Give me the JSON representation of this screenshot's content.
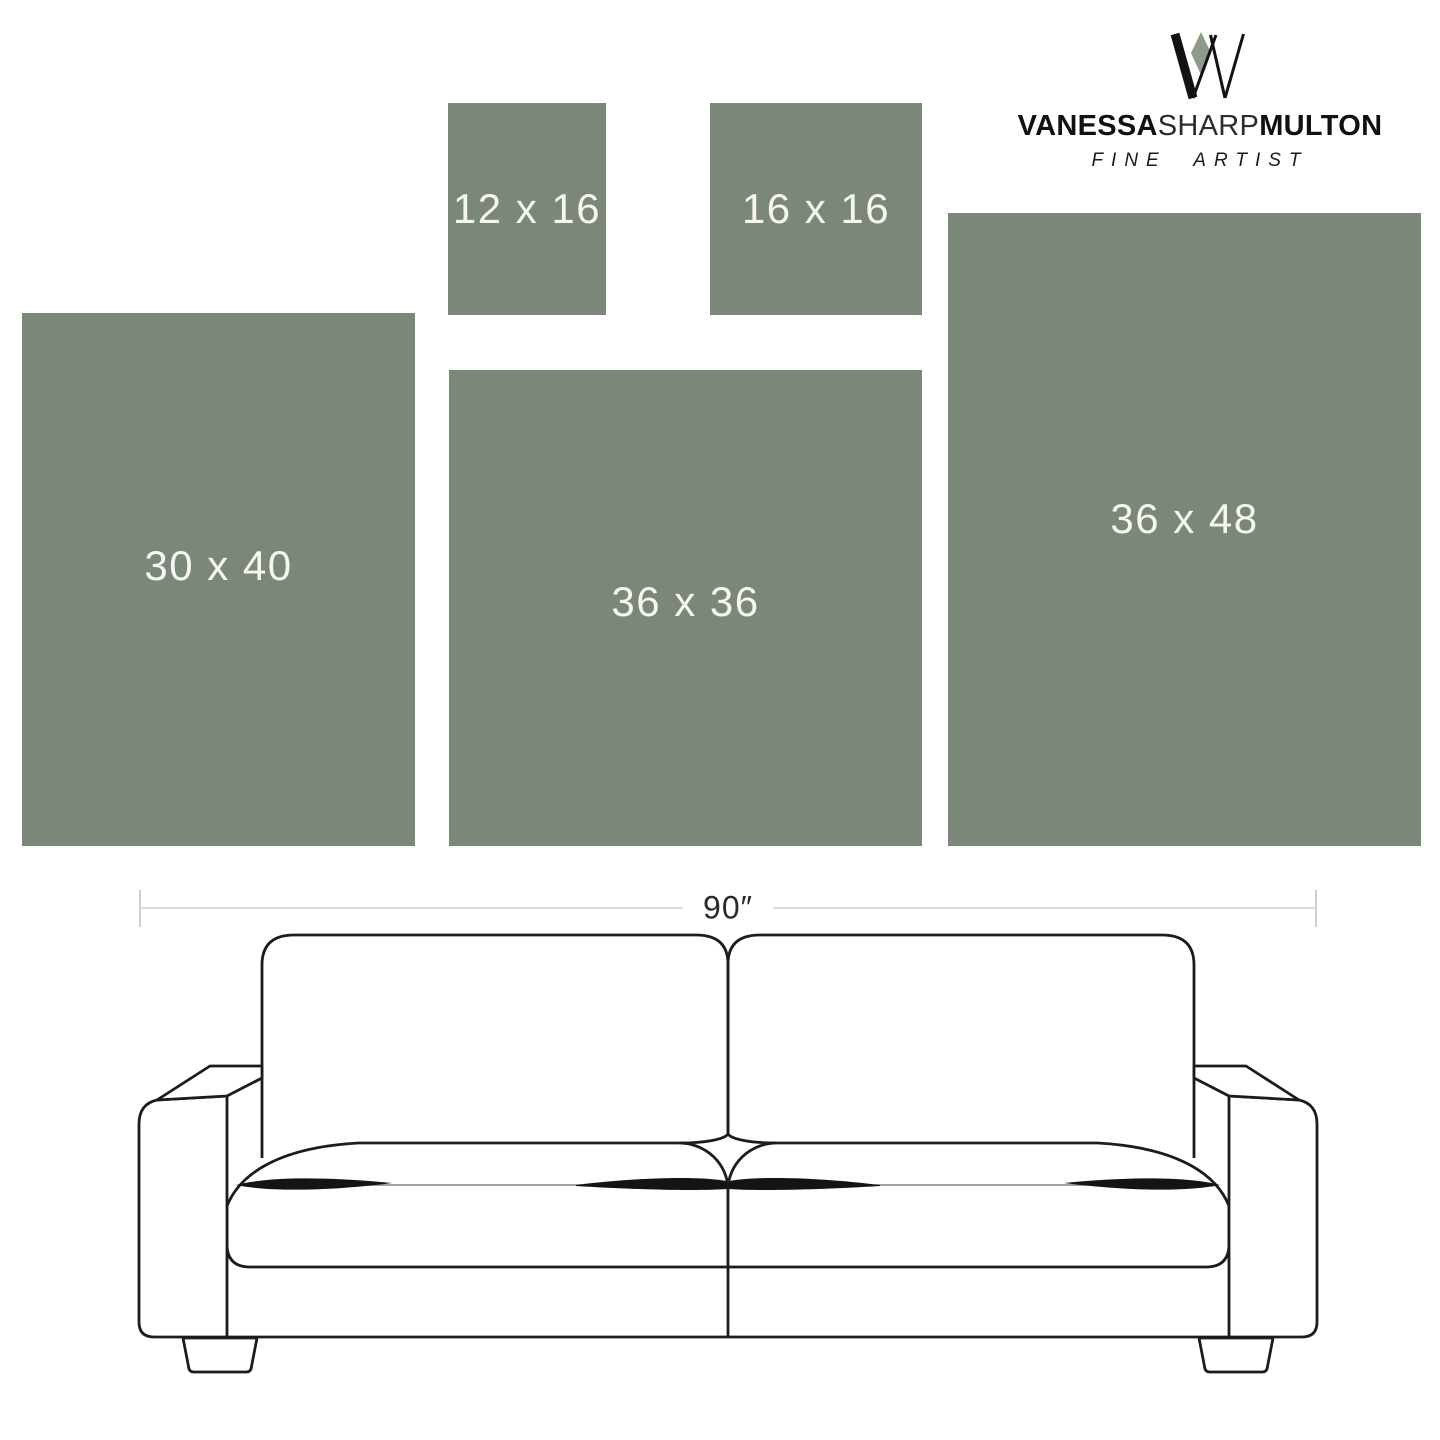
{
  "brand": {
    "wordmark_part1": "VANESSA",
    "wordmark_part2": "SHARP",
    "wordmark_part3": "MULTON",
    "tagline": "FINE ARTIST",
    "mark_accent_color": "#8f9b86",
    "mark_ink_color": "#121212"
  },
  "size_chart": {
    "unit": "inches",
    "swatch_color": "#7b8779",
    "label_color": "#f6f6f3",
    "sizes": [
      {
        "label": "12 x 16",
        "width_in": 12,
        "height_in": 16
      },
      {
        "label": "16 x 16",
        "width_in": 16,
        "height_in": 16
      },
      {
        "label": "30 x 40",
        "width_in": 30,
        "height_in": 40
      },
      {
        "label": "36 x 36",
        "width_in": 36,
        "height_in": 36
      },
      {
        "label": "36 x 48",
        "width_in": 36,
        "height_in": 48
      }
    ]
  },
  "sofa": {
    "width_label": "90″",
    "width_inches": 90,
    "seats": 2
  }
}
